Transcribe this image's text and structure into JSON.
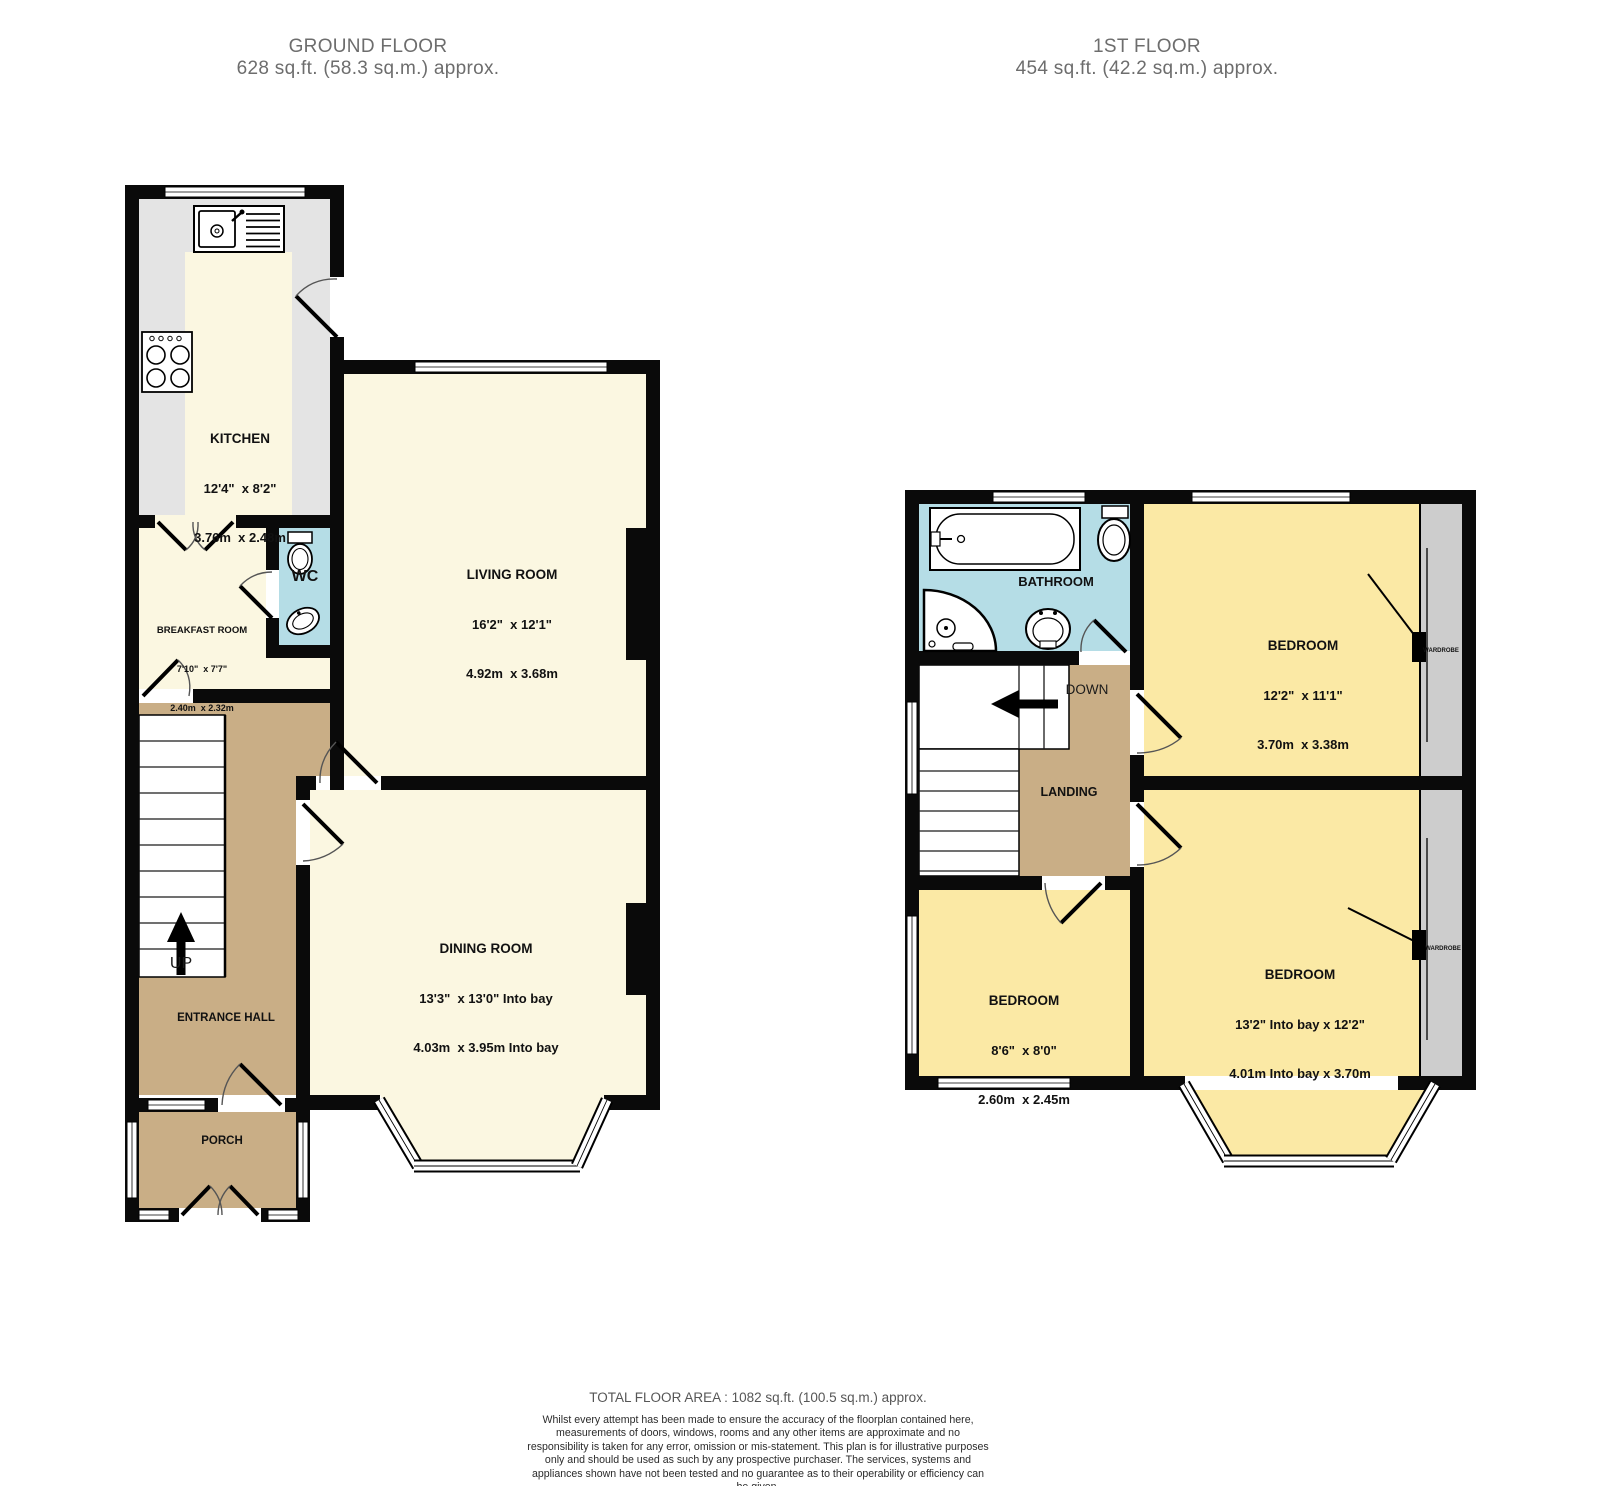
{
  "titles": {
    "ground_floor": {
      "name": "GROUND FLOOR",
      "area": "628 sq.ft. (58.3 sq.m.) approx."
    },
    "first_floor": {
      "name": "1ST FLOOR",
      "area": "454 sq.ft. (42.2 sq.m.) approx."
    }
  },
  "ground_floor": {
    "kitchen": {
      "name": "KITCHEN",
      "imperial": "12'4\"  x 8'2\"",
      "metric": "3.76m  x 2.48m"
    },
    "breakfast_room": {
      "name": "BREAKFAST ROOM",
      "imperial": "7'10\"  x 7'7\"",
      "metric": "2.40m  x 2.32m"
    },
    "wc": {
      "name": "WC"
    },
    "living_room": {
      "name": "LIVING ROOM",
      "imperial": "16'2\"  x 12'1\"",
      "metric": "4.92m  x 3.68m"
    },
    "dining_room": {
      "name": "DINING ROOM",
      "imperial": "13'3\"  x 13'0\" Into bay",
      "metric": "4.03m  x 3.95m Into bay"
    },
    "entrance_hall": {
      "name": "ENTRANCE HALL"
    },
    "porch": {
      "name": "PORCH"
    },
    "stairs": {
      "direction": "UP"
    }
  },
  "first_floor": {
    "bathroom": {
      "name": "BATHROOM"
    },
    "landing": {
      "name": "LANDING"
    },
    "stairs": {
      "direction": "DOWN"
    },
    "bedroom_front": {
      "name": "BEDROOM",
      "imperial": "13'2\" Into bay x 12'2\"",
      "metric": "4.01m Into bay x 3.70m"
    },
    "bedroom_rear": {
      "name": "BEDROOM",
      "imperial": "12'2\"  x 11'1\"",
      "metric": "3.70m  x 3.38m"
    },
    "bedroom_small": {
      "name": "BEDROOM",
      "imperial": "8'6\"  x 8'0\"",
      "metric": "2.60m  x 2.45m"
    },
    "wardrobe_rear": {
      "name": "WARDROBE"
    },
    "wardrobe_front": {
      "name": "WARDROBE"
    }
  },
  "footer": {
    "total": "TOTAL FLOOR AREA : 1082 sq.ft. (100.5 sq.m.) approx.",
    "disclaimer": "Whilst every attempt has been made to ensure the accuracy of the floorplan contained here, measurements of doors, windows, rooms and any other items are approximate and no responsibility is taken for any error, omission or mis-statement. This plan is for illustrative purposes only and should be used as such by any prospective purchaser. The services, systems and appliances shown have not been tested and no guarantee as to their operability or efficiency can be given.",
    "credit": "Made with Metropix ©2025"
  },
  "colors": {
    "wall": "#0a0a0a",
    "floor_cream": "#fbf7e1",
    "floor_yellow": "#fbe9a5",
    "floor_tan": "#c9ae86",
    "floor_blue": "#b5dde6",
    "counter_gray": "#e4e4e4",
    "wardrobe_gray": "#cdcdcd",
    "title_gray": "#6d6d6d"
  }
}
